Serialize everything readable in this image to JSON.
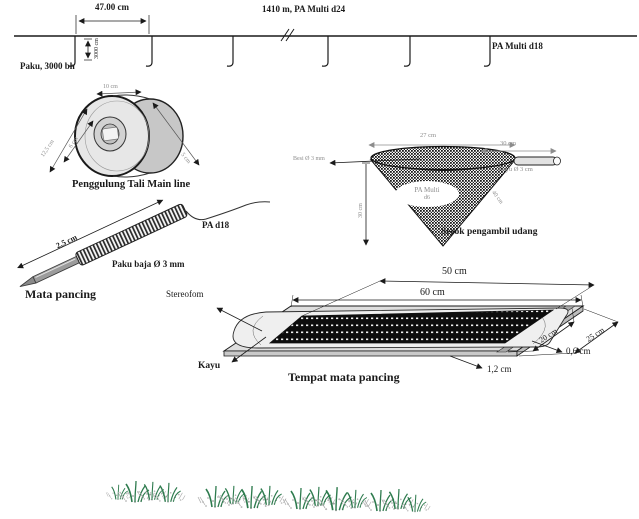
{
  "colors": {
    "ink": "#1a1a1a",
    "faint": "#8c8c8c",
    "grass": "#2e7b4e"
  },
  "mainline": {
    "dim_spacing": "47.00 cm",
    "dim_depth": "3000 cm",
    "label_line": "1410 m, PA Multi d24",
    "label_branch": "PA Multi d18",
    "label_nails": "Paku, 3000 bh"
  },
  "spool": {
    "caption": "Penggulung Tali Main line",
    "dim_width": "10 cm",
    "dim_outer": "12,5 cm",
    "dim_inner": "6 cm",
    "dim_hub": "5 cm"
  },
  "scoop": {
    "caption": "Serok pengambil udang",
    "dim_mouth": "27 cm",
    "dim_handle": "30 cm",
    "label_handle": "Kayu Ø 3 cm",
    "label_frame": "Besi Ø 3 mm",
    "dim_depth": "30 cm",
    "dim_side": "40 cm",
    "net_label_line1": "PA Multi",
    "net_label_line2": "d6"
  },
  "hook": {
    "caption": "Mata pancing",
    "dim_length": "2,5 cm",
    "label_line": "PA d18",
    "label_nail": "Paku baja Ø 3 mm"
  },
  "tray": {
    "caption": "Tempat mata pancing",
    "dim_inner_length": "50 cm",
    "dim_outer_length": "60 cm",
    "dim_inner_width": "20 cm",
    "dim_outer_width": "25 cm",
    "dim_foam_thickness": "0,6 cm",
    "dim_board_thickness": "1,2 cm",
    "label_foam": "Stereofom",
    "label_board": "Kayu"
  }
}
